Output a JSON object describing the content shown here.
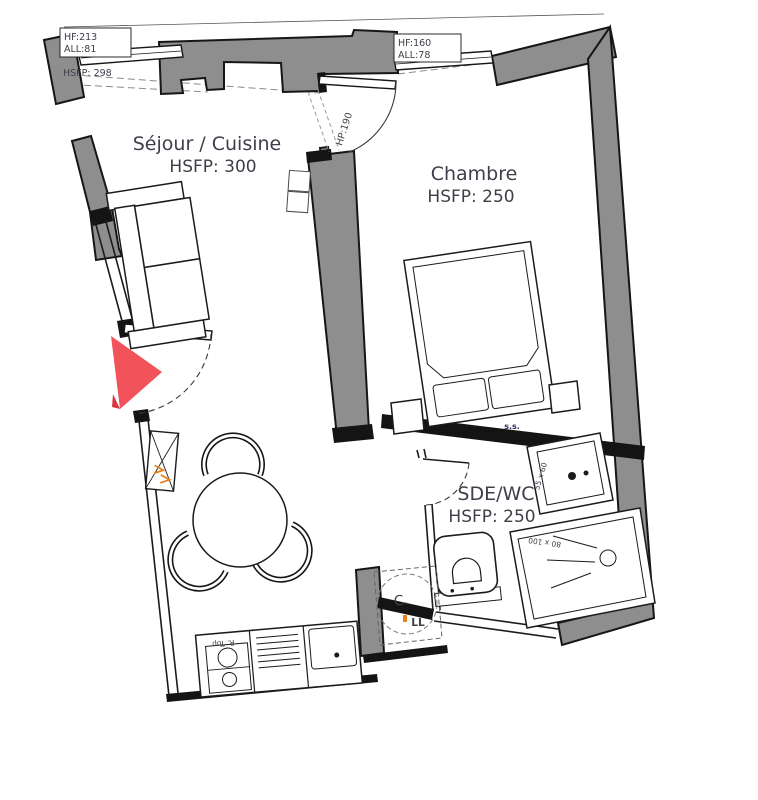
{
  "rooms": {
    "sejour": {
      "name": "Séjour / Cuisine",
      "hsfp": "HSFP: 300"
    },
    "chambre": {
      "name": "Chambre",
      "hsfp": "HSFP: 250"
    },
    "sde": {
      "name": "SDE/WC",
      "hsfp": "HSFP: 250"
    }
  },
  "openings": {
    "window_left": {
      "hf": "HF:213",
      "all": "ALL:81"
    },
    "window_right": {
      "hf": "HF:160",
      "all": "ALL:78"
    },
    "ceiling": "HSFP: 298",
    "chambre_door": "HP:190"
  },
  "fixtures": {
    "washbasin_dim": "55 x 60",
    "shower_dim": "80 x 100",
    "towel_rail": "s.s.",
    "water_heater": "C.",
    "washing_machine": "LL",
    "fridge": "R. Top"
  },
  "colors": {
    "wall": "#8e8e8e",
    "entry_arrow": "#f2525a",
    "label": "#3d4049"
  }
}
